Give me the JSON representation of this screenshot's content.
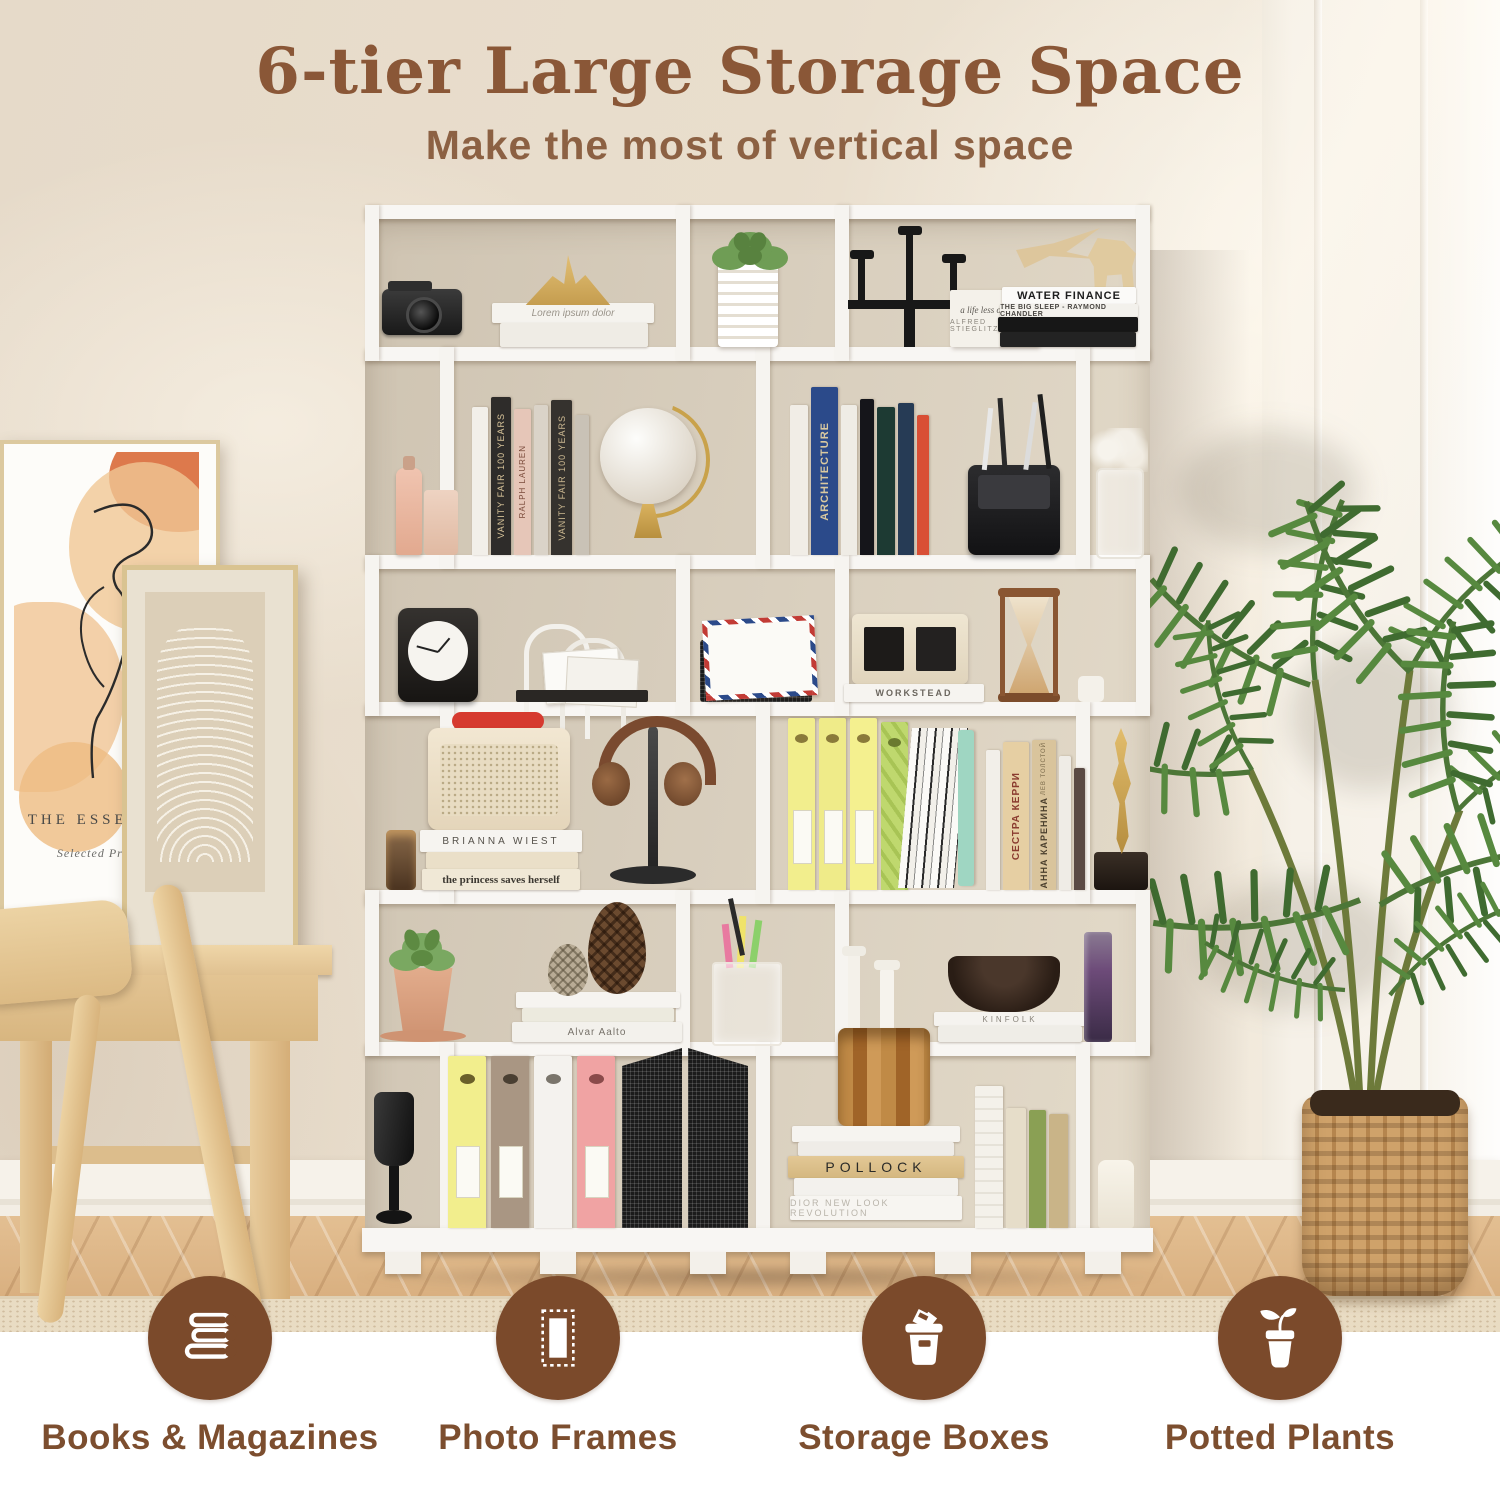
{
  "header": {
    "title": "6-tier Large Storage Space",
    "subtitle": "Make the most of vertical space"
  },
  "features": [
    {
      "id": "books",
      "icon": "books-icon",
      "label": "Books & Magazines"
    },
    {
      "id": "frames",
      "icon": "photo-frame-icon",
      "label": "Photo Frames"
    },
    {
      "id": "boxes",
      "icon": "storage-box-icon",
      "label": "Storage Boxes"
    },
    {
      "id": "plants",
      "icon": "potted-plant-icon",
      "label": "Potted Plants"
    }
  ],
  "artwork": {
    "poster_title": "THE ESSENCE O",
    "poster_caption": "Selected Prints:19"
  },
  "shelf": {
    "tier_count": 6,
    "spines": {
      "lorem": "Lorem ipsum dolor",
      "life_less_ordinary": "a life less ordinary",
      "stieglitz": "ALFRED STIEGLITZ",
      "water_finance": "WATER FINANCE",
      "big_sleep": "THE BIG SLEEP - RAYMOND CHANDLER",
      "vanity_fair": "VANITY FAIR 100 YEARS",
      "ralph_lauren": "RALPH LAUREN",
      "architecture": "ARCHITECTURE",
      "workstead": "WORKSTEAD",
      "brianna": "BRIANNA WIEST",
      "princess": "the princess saves herself",
      "alvar": "Alvar Aalto",
      "sister_carrie": "СЕСТРА КЕРРИ",
      "tolstoy": "ЛЕВ ТОЛСТОЙ",
      "anna_karenina": "АННА КАРЕНИНА",
      "kinfolk": "KINFOLK",
      "pollock": "POLLOCK",
      "dior": "DIOR  NEW LOOK REVOLUTION"
    }
  },
  "colors": {
    "title_brown": "#8a5737",
    "label_brown": "#7c4e2f",
    "icon_circle_brown": "#7b4a2b",
    "wall_cream": "#e9dfd2",
    "shelf_white": "#f7f5f2",
    "floor_wood": "#d9b183",
    "accent_red": "#d63a2f",
    "folder_yellow": "#f2ee8d",
    "plant_green": "#5f8f46"
  }
}
